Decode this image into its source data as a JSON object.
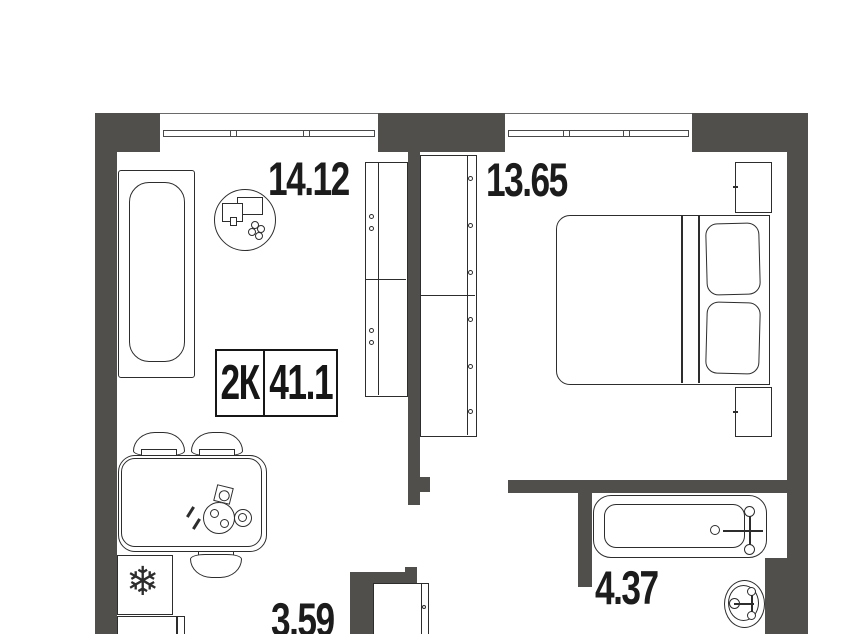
{
  "plan": {
    "apartment": {
      "type_label": "2К",
      "total_area": "41.1"
    },
    "rooms": [
      {
        "id": "living-room",
        "area_label": "14.12"
      },
      {
        "id": "bedroom",
        "area_label": "13.65"
      },
      {
        "id": "bathroom",
        "area_label": "4.37"
      },
      {
        "id": "kitchen-hall",
        "area_label": "3.59"
      }
    ],
    "icons": {
      "fridge_snowflake": "❄"
    },
    "colors": {
      "wall": "#514f4c",
      "line": "#2d2d2d",
      "text": "#1c1c1c",
      "background": "#ffffff"
    }
  }
}
